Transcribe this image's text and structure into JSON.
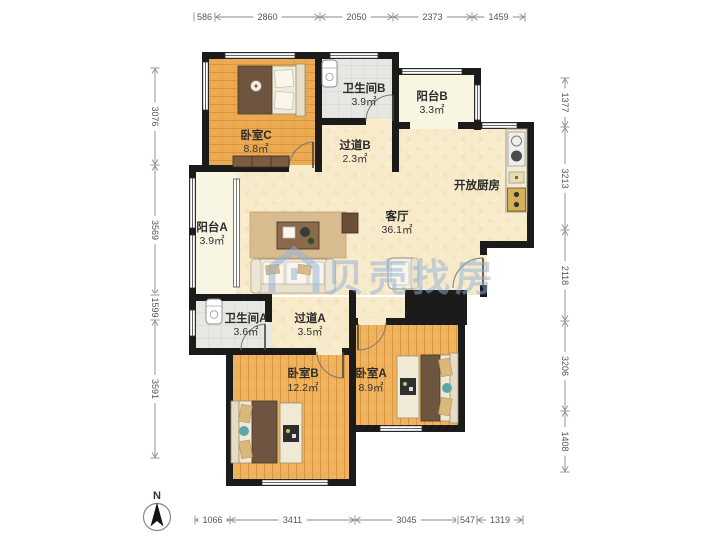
{
  "watermark": {
    "text": "贝壳找房",
    "color": "#8fb0dd"
  },
  "compass": {
    "label": "N"
  },
  "rooms": [
    {
      "id": "bedroom-c",
      "name": "卧室C",
      "area": "8.8㎡"
    },
    {
      "id": "bath-b",
      "name": "卫生间B",
      "area": "3.9㎡"
    },
    {
      "id": "balcony-b",
      "name": "阳台B",
      "area": "3.3㎡"
    },
    {
      "id": "corridor-b",
      "name": "过道B",
      "area": "2.3㎡"
    },
    {
      "id": "kitchen",
      "name": "开放厨房",
      "area": ""
    },
    {
      "id": "living",
      "name": "客厅",
      "area": "36.1㎡"
    },
    {
      "id": "balcony-a",
      "name": "阳台A",
      "area": "3.9㎡"
    },
    {
      "id": "bath-a",
      "name": "卫生间A",
      "area": "3.6㎡"
    },
    {
      "id": "corridor-a",
      "name": "过道A",
      "area": "3.5㎡"
    },
    {
      "id": "bedroom-b",
      "name": "卧室B",
      "area": "12.2㎡"
    },
    {
      "id": "bedroom-a",
      "name": "卧室A",
      "area": "8.9㎡"
    }
  ],
  "dimensions": {
    "top": [
      "586",
      "2860",
      "2050",
      "2373",
      "1459"
    ],
    "bottom": [
      "1066",
      "3411",
      "3045",
      "547",
      "1319"
    ],
    "left": [
      "3076",
      "3569",
      "1599",
      "3591"
    ],
    "right": [
      "1377",
      "3213",
      "2118",
      "3206",
      "1408"
    ]
  }
}
